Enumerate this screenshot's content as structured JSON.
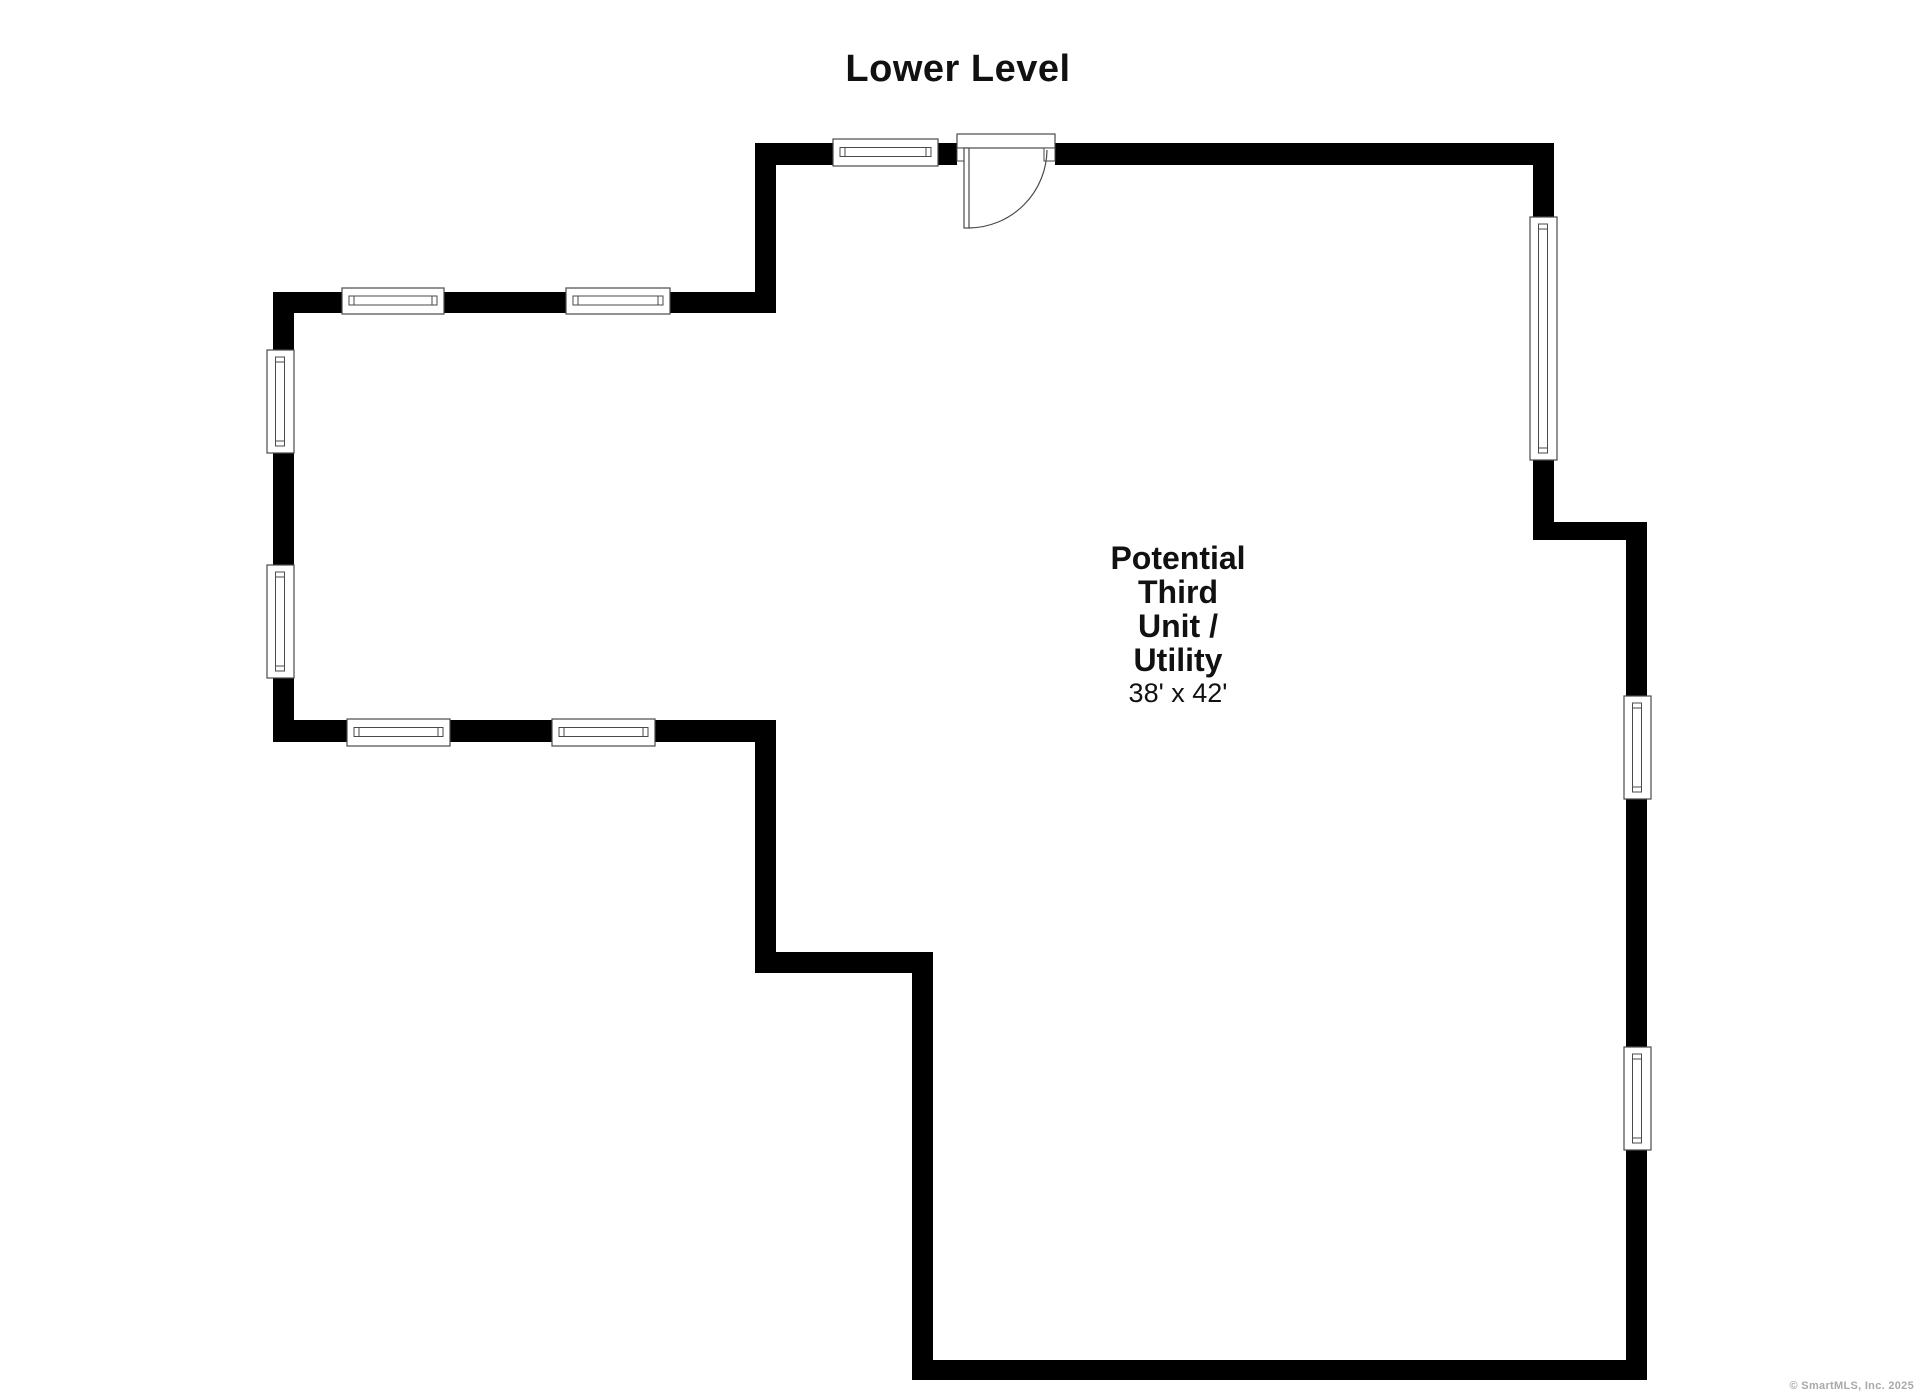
{
  "page": {
    "width": 1920,
    "height": 1396,
    "background": "#ffffff"
  },
  "title": "Lower Level",
  "room_label": {
    "lines": [
      "Potential",
      "Third",
      "Unit /",
      "Utility"
    ],
    "dimensions": "38' x 42'"
  },
  "footer": {
    "copyright": "© SmartMLS, Inc.  2025"
  },
  "colors": {
    "wall": "#000000",
    "window_stroke": "#4a4a4a",
    "window_fill": "#ffffff",
    "door_stroke": "#4a4a4a",
    "text": "#111111",
    "copyright": "#a9a9a9"
  },
  "floorplan": {
    "walls": [
      {
        "name": "top-wall-left-of-door",
        "x": 755,
        "y": 143,
        "w": 202,
        "h": 22
      },
      {
        "name": "top-wall-right-of-door",
        "x": 1055,
        "y": 143,
        "w": 499,
        "h": 22
      },
      {
        "name": "upper-left-jog-wall",
        "x": 755,
        "y": 143,
        "w": 21,
        "h": 170
      },
      {
        "name": "west-wing-top-wall",
        "x": 273,
        "y": 292,
        "w": 502,
        "h": 21
      },
      {
        "name": "west-exterior-wall",
        "x": 273,
        "y": 292,
        "w": 21,
        "h": 450
      },
      {
        "name": "west-wing-bottom-wall",
        "x": 273,
        "y": 720,
        "w": 503,
        "h": 22
      },
      {
        "name": "mid-left-vertical-wall",
        "x": 755,
        "y": 720,
        "w": 21,
        "h": 253
      },
      {
        "name": "mid-step-horizontal-wall",
        "x": 755,
        "y": 952,
        "w": 178,
        "h": 21
      },
      {
        "name": "lower-left-vertical-wall",
        "x": 912,
        "y": 952,
        "w": 21,
        "h": 428
      },
      {
        "name": "south-wall",
        "x": 912,
        "y": 1360,
        "w": 735,
        "h": 20
      },
      {
        "name": "east-wall-lower",
        "x": 1626,
        "y": 522,
        "w": 21,
        "h": 858
      },
      {
        "name": "east-step-wall",
        "x": 1533,
        "y": 522,
        "w": 114,
        "h": 18
      },
      {
        "name": "east-wall-upper",
        "x": 1533,
        "y": 143,
        "w": 21,
        "h": 397
      }
    ],
    "windows": [
      {
        "type": "h",
        "name": "top-wall-window",
        "x": 833,
        "y": 139,
        "w": 105,
        "h": 27
      },
      {
        "type": "h",
        "name": "west-wing-top-window-1",
        "x": 342,
        "y": 288,
        "w": 102,
        "h": 26
      },
      {
        "type": "h",
        "name": "west-wing-top-window-2",
        "x": 566,
        "y": 288,
        "w": 104,
        "h": 26
      },
      {
        "type": "h",
        "name": "west-wing-bottom-window-1",
        "x": 347,
        "y": 719,
        "w": 103,
        "h": 27
      },
      {
        "type": "h",
        "name": "west-wing-bottom-window-2",
        "x": 552,
        "y": 719,
        "w": 103,
        "h": 27
      },
      {
        "type": "v",
        "name": "west-wall-window-1",
        "x": 267,
        "y": 350,
        "w": 27,
        "h": 103
      },
      {
        "type": "v",
        "name": "west-wall-window-2",
        "x": 267,
        "y": 565,
        "w": 27,
        "h": 113
      },
      {
        "type": "v",
        "name": "east-wall-upper-window",
        "x": 1530,
        "y": 217,
        "w": 27,
        "h": 243
      },
      {
        "type": "v",
        "name": "east-wall-lower-window-1",
        "x": 1624,
        "y": 696,
        "w": 27,
        "h": 103
      },
      {
        "type": "v",
        "name": "east-wall-lower-window-2",
        "x": 1624,
        "y": 1047,
        "w": 27,
        "h": 103
      }
    ],
    "door": {
      "header": {
        "x": 957,
        "y": 134,
        "w": 98,
        "h": 14
      },
      "jamb_left": {
        "x": 957,
        "y": 148,
        "w": 11,
        "h": 13
      },
      "jamb_right": {
        "x": 1044,
        "y": 148,
        "w": 11,
        "h": 13
      },
      "leaf": {
        "x": 964,
        "y": 148,
        "w": 5,
        "h": 80
      },
      "swing_arc": "M 969 228 A 79 79 0 0 0 1047 150"
    }
  }
}
